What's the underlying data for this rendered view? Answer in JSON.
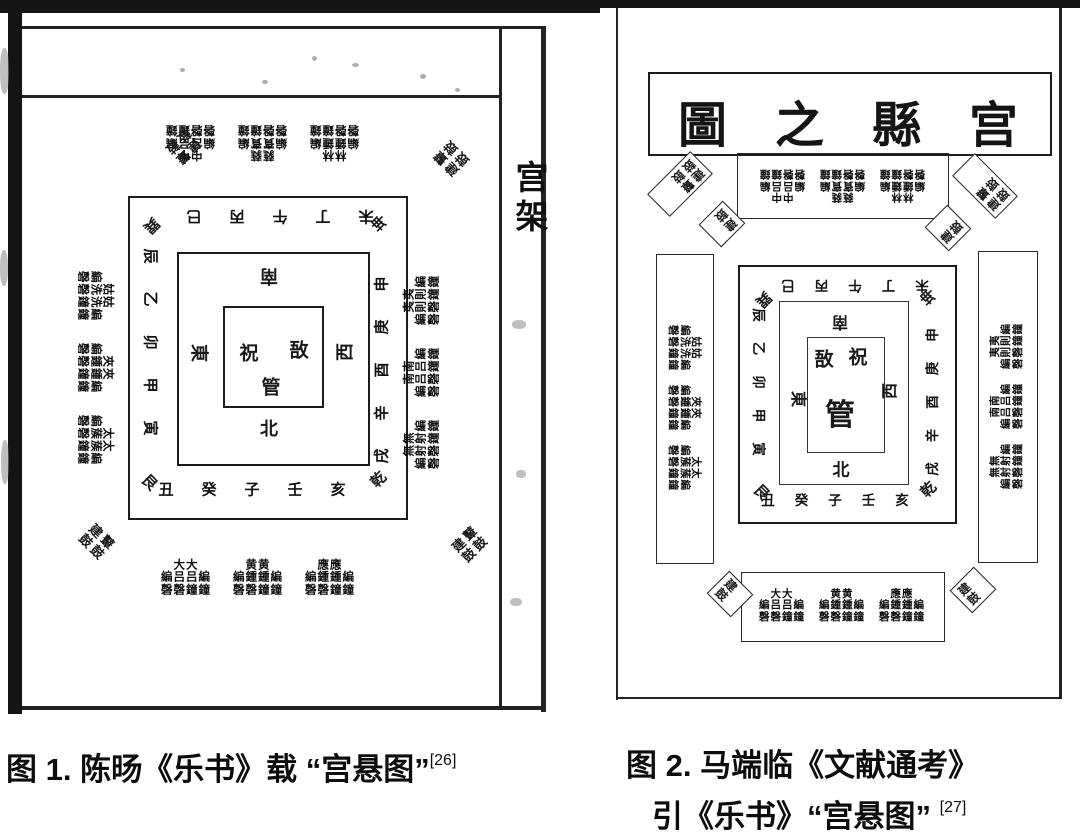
{
  "figure1": {
    "margin_label": "宫架",
    "caption": {
      "text": "图 1. 陈旸《乐书》载 “宫悬图”",
      "ref": "[26]"
    },
    "diagram": {
      "center_instruments": {
        "left": "祝",
        "right": "敔",
        "bottom": "管"
      },
      "directions": {
        "top": "南",
        "bottom": "北",
        "left": "東",
        "right": "西"
      },
      "stems_branches": {
        "top": "巳丙午丁未",
        "bottom": "丑癸子壬亥",
        "left": "辰乙卯甲寅",
        "right": "申庚酉辛戌"
      },
      "trigrams": {
        "top_left": "巽",
        "top_right": "坤",
        "bottom_left": "艮",
        "bottom_right": "乾"
      },
      "bell_bands": {
        "top": [
          "中吕",
          "蕤賓",
          "林鍾"
        ],
        "left": [
          "姑洗",
          "夾鍾",
          "太蔟"
        ],
        "right": [
          "夷則",
          "南吕",
          "無射"
        ],
        "bottom": [
          "大吕",
          "黄鍾",
          "應鍾"
        ]
      },
      "instruments": {
        "bian": "編",
        "zhong": "鐘",
        "qing": "磬"
      },
      "corner_drums": [
        "建鼓",
        "鼙鼓"
      ]
    }
  },
  "figure2": {
    "title": "圖之縣宫",
    "caption": {
      "line1": "图 2. 马端临《文献通考》",
      "line2": "引《乐书》“宫悬图”",
      "ref": "[27]"
    },
    "diagram": {
      "center_instruments": {
        "left": "敔",
        "right": "祝",
        "bottom": "管"
      },
      "directions": {
        "top": "南",
        "bottom": "北",
        "left": "東",
        "right": "西"
      },
      "stems_branches": {
        "top": "巳丙午丁未",
        "bottom": "丑癸子壬亥",
        "left": "辰乙卯甲寅",
        "right": "申庚酉辛戌"
      },
      "trigrams": {
        "top_left": "巽",
        "top_right": "坤",
        "bottom_left": "艮",
        "bottom_right": "乾"
      },
      "bell_bands": {
        "top": [
          "中吕",
          "蕤賓",
          "林鍾"
        ],
        "left": [
          "姑洗",
          "夾鍾",
          "太蔟"
        ],
        "right": [
          "夷則",
          "南吕",
          "無射"
        ],
        "bottom": [
          "大吕",
          "黄鍾",
          "應鍾"
        ]
      },
      "instruments": {
        "bian": "編",
        "zhong": "鐘",
        "qing": "磬"
      },
      "corner_drums": [
        "建鼓",
        "鼙鼓"
      ]
    }
  }
}
